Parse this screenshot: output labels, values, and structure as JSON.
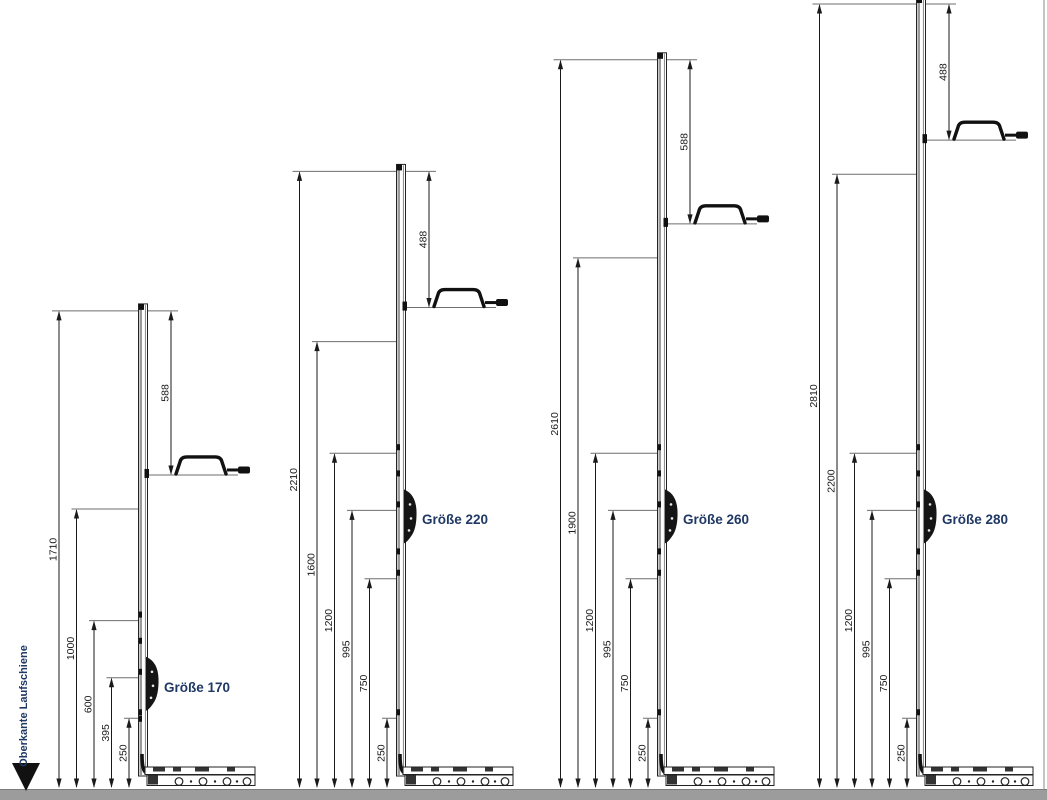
{
  "diagram": {
    "baseline_label": "Oberkante Laufschiene",
    "units": "mm",
    "groups": [
      {
        "label": "Größe 170",
        "total_height": 1710,
        "left_dimensions": [
          1710,
          1000,
          600,
          395,
          250
        ],
        "top_dimension": 588,
        "lock_height": 395
      },
      {
        "label": "Größe 220",
        "total_height": 2210,
        "left_dimensions": [
          2210,
          1600,
          1200,
          995,
          750,
          250
        ],
        "top_dimension": 488,
        "lock_height": 995
      },
      {
        "label": "Größe 260",
        "total_height": 2610,
        "left_dimensions": [
          2610,
          1900,
          1200,
          995,
          750,
          250
        ],
        "top_dimension": 588,
        "lock_height": 995
      },
      {
        "label": "Größe 280",
        "total_height": 2810,
        "left_dimensions": [
          2810,
          2200,
          1200,
          995,
          750,
          250
        ],
        "top_dimension": 488,
        "lock_height": 995
      }
    ],
    "colors": {
      "label_navy": "#1f3864",
      "line_black": "#1a1a1a",
      "extension_gray": "#6e6e6e",
      "ground_gray": "#9c9c9c",
      "hardware_black": "#151515"
    }
  }
}
